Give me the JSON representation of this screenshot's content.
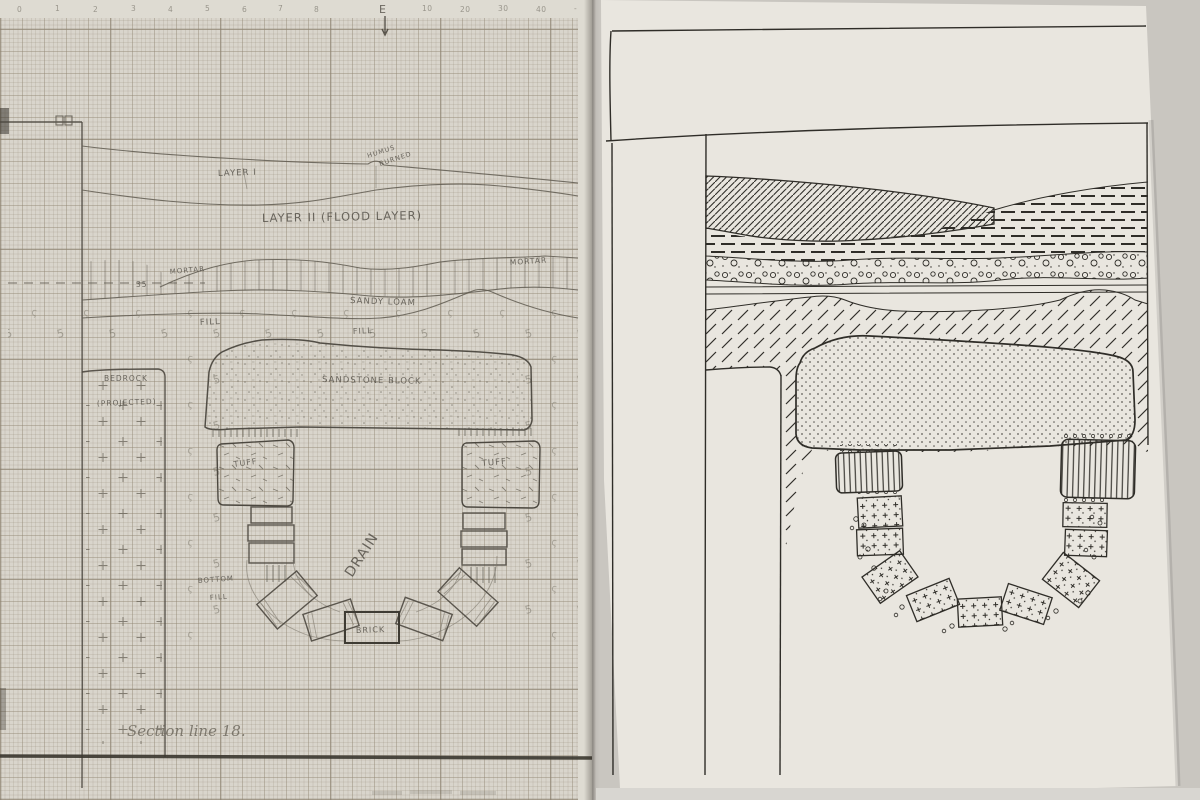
{
  "photo": {
    "backdrop_color": "#c9c6c0",
    "left_paper_color": "#d9d5cc",
    "right_paper_color": "#e9e6df",
    "pencil_color": "#5f5b50",
    "ink_color": "#2f2d28"
  },
  "left_sheet": {
    "medium": "pencil-on-graph-paper",
    "ruler": {
      "ticks": [
        "0",
        "1",
        "2",
        "3",
        "4",
        "5",
        "6",
        "7",
        "8",
        "E",
        "10",
        "20",
        "30",
        "40",
        "-"
      ]
    },
    "labels": {
      "layer1": "LAYER I",
      "humus1": "HUMUS",
      "humus2": "BURNED",
      "layer2": "LAYER II (FLOOD LAYER)",
      "mortar_left": "MORTAR",
      "mortar_right": "MORTAR",
      "level": "35",
      "sandy_loam": "SANDY LOAM",
      "fill_upper": "FILL",
      "fill_mid": "FILL",
      "sandstone": "SANDSTONE BLOCK",
      "bedrock": "BEDROCK",
      "bedrock_note": "(PROJECTED)",
      "tuff_left": "TUFF",
      "tuff_right": "TUFF",
      "drain": "DRAIN",
      "bottom_fill1": "BOTTOM",
      "bottom_fill2": "FILL",
      "brick": "BRICK",
      "signature": "Section line 18."
    }
  },
  "right_sheet": {
    "medium": "ink-on-plain-paper",
    "patterns": [
      "humus-diagonal-hatch",
      "flood-layer-dash-courses",
      "mortar-pebble-band",
      "fill-diagonal-dashes",
      "sandstone-stipple",
      "tuff-vertical-stripes",
      "drain-brick-crosses"
    ]
  }
}
